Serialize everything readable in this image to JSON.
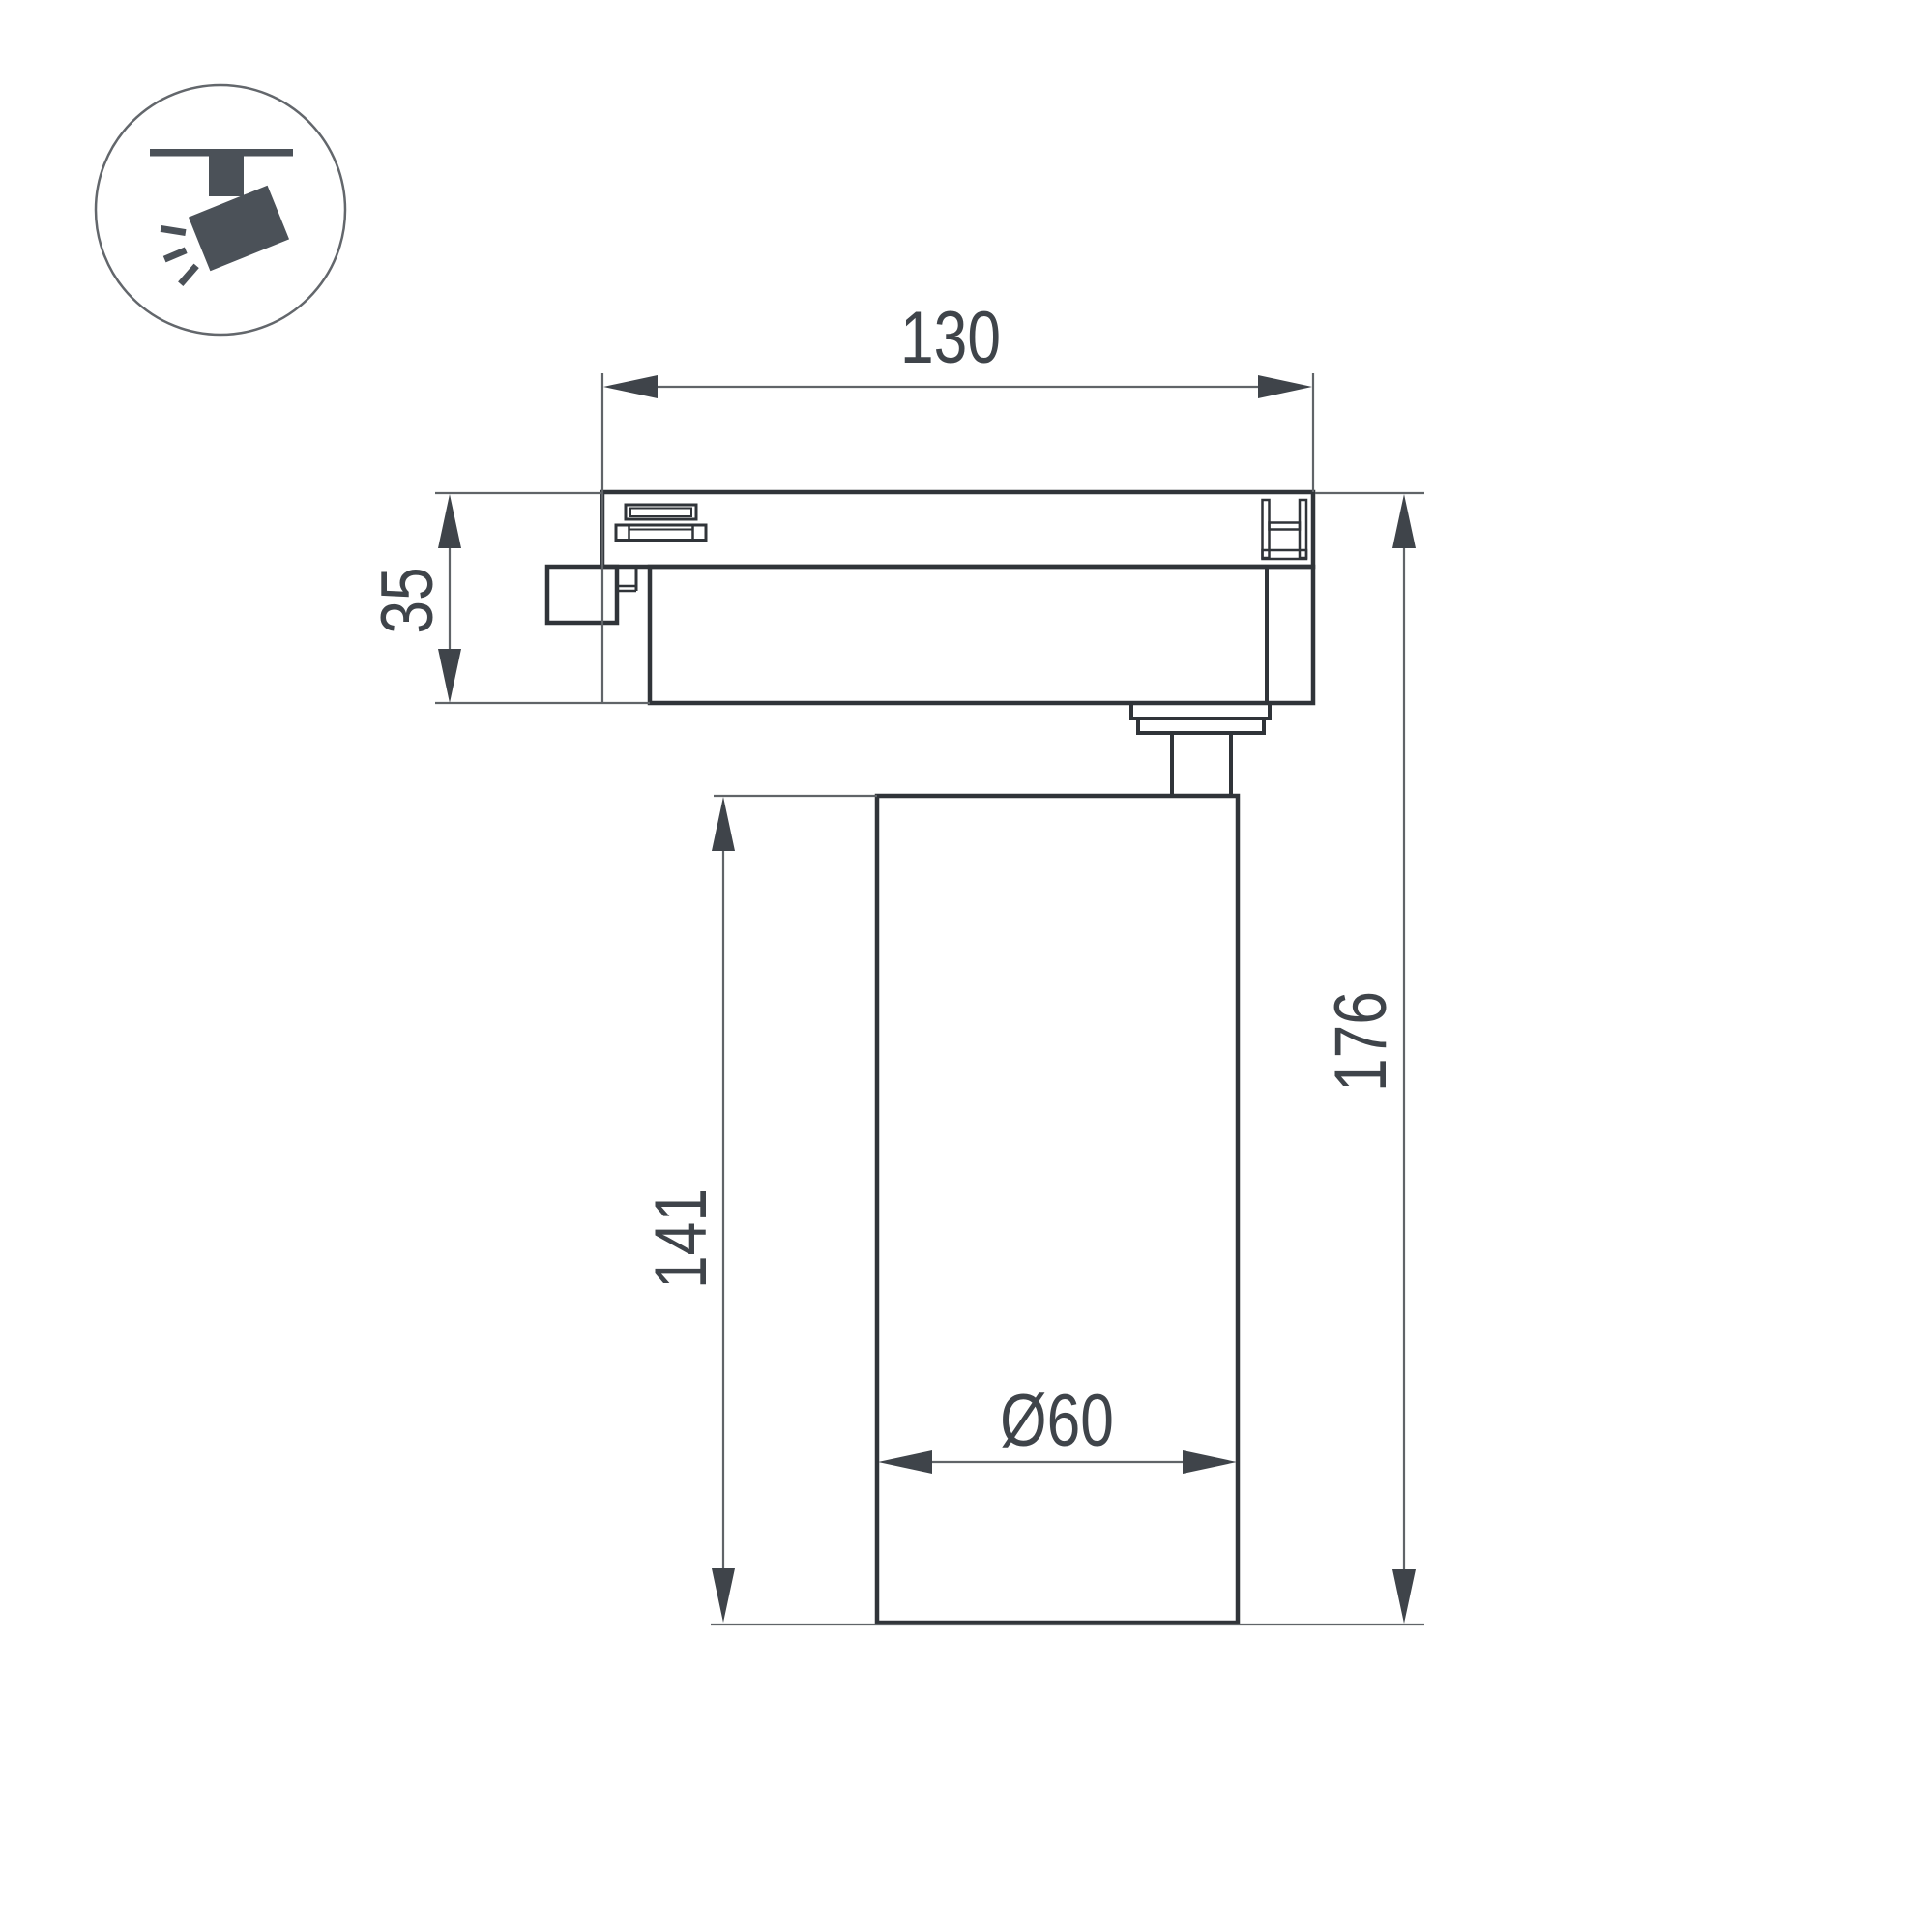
{
  "page": {
    "type": "technical-drawing",
    "background": "#ffffff",
    "subject": "track-mounted spotlight side view with dimensions"
  },
  "icon": {
    "name": "track-spotlight-badge",
    "description": "ceiling track with tilted spotlight head and light rays"
  },
  "dimensions": {
    "track_width": "130",
    "adapter_height": "35",
    "body_height": "141",
    "total_height": "176",
    "diameter": "Ø60"
  },
  "colors": {
    "outline_thick": "#303439",
    "outline_thin": "#606468",
    "annotation": "#3f444a",
    "icon_fill": "#4b5158",
    "icon_circle_stroke": "#63676c",
    "background": "#ffffff"
  }
}
